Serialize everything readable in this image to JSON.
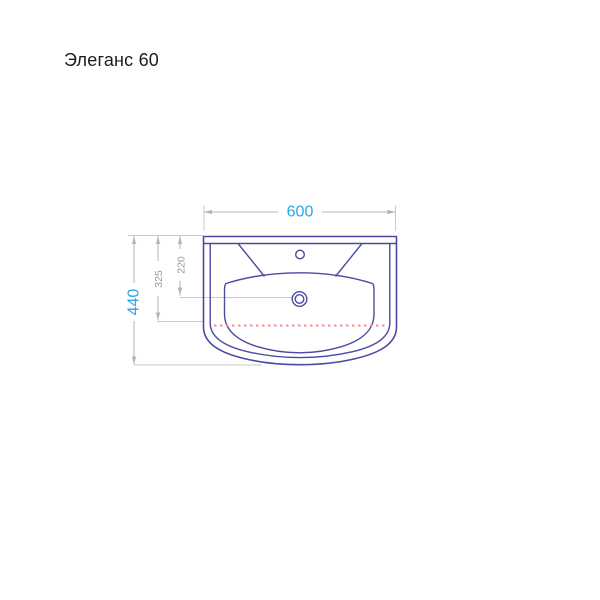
{
  "title": "Элеганс 60",
  "drawing": {
    "type": "washbasin-top-view-technical-drawing",
    "dims": {
      "width": "600",
      "height": "440",
      "depth_to_front_edge": "325",
      "drain_center_offset": "220"
    },
    "colors": {
      "outline": "#4a4aa0",
      "dimension_lines": "#b3b3b3",
      "extension_lines": "#c9c9c9",
      "dashed_front_line": "#f08f8f",
      "accent_dim_text": "#2aa7e0",
      "secondary_dim_text": "#9a9a9a",
      "title_text": "#1c1c1c",
      "background": "#ffffff"
    }
  }
}
